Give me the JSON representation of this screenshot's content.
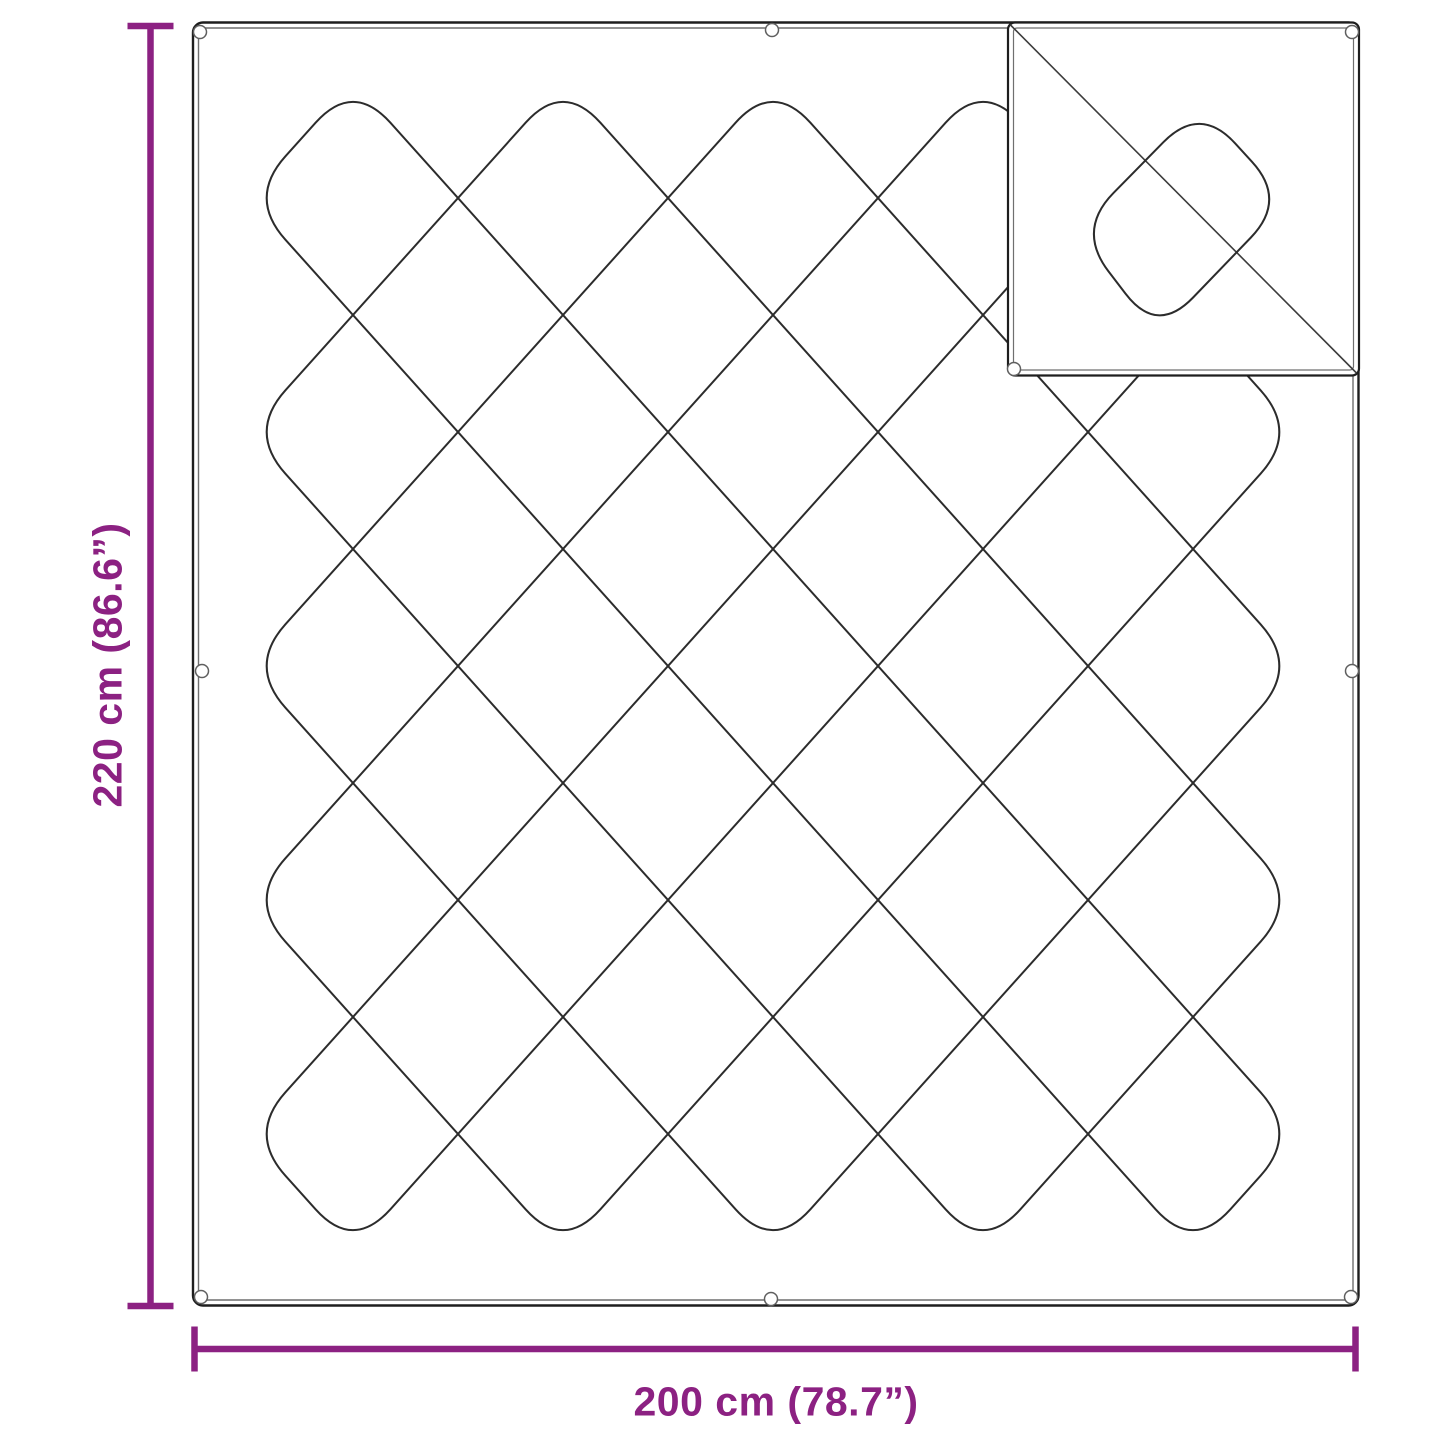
{
  "diagram": {
    "height_dimension": {
      "label": "220 cm (86.6”)"
    },
    "width_dimension": {
      "label": "200 cm (78.7”)"
    },
    "colors": {
      "dimension": "#8C2182",
      "line": "#2C2C2C",
      "border": "#1E1E1E",
      "inner-border": "#6F6F6F",
      "grommet": "#5F5F5F"
    }
  }
}
